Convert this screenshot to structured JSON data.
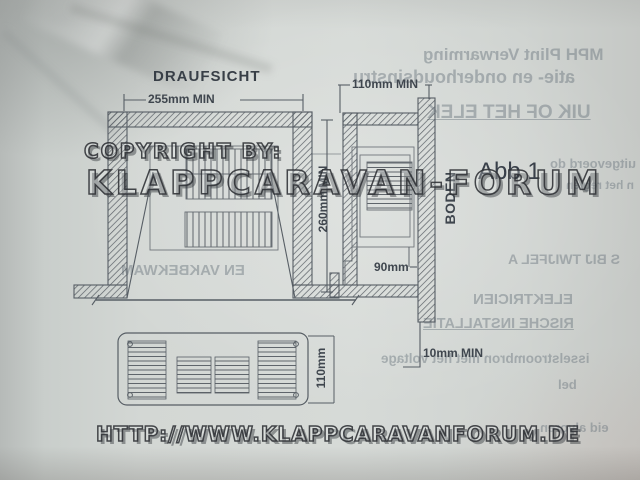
{
  "drawing": {
    "title": "DRAUFSICHT",
    "figure_label": "Abb 1",
    "floor_label": "BODEN",
    "dim_top_width": "255mm MIN",
    "dim_side_depth": "110mm MIN",
    "dim_side_height": "260mm MIN",
    "dim_duct": "90mm",
    "dim_floor_gap": "10mm MIN",
    "dim_grille_height": "110mm"
  },
  "watermark": {
    "copyright": "COPYRIGHT BY:",
    "forum": "KLAPPCARAVAN-FORUM",
    "url": "HTTP://WWW.KLAPPCARAVANFORUM.DE"
  },
  "bleedthrough": {
    "items": [
      {
        "text": "MPH Plint Verwarming"
      },
      {
        "text": "atie- en onderhoudsinstru"
      },
      {
        "text": "UIK OF HET ELEK"
      },
      {
        "text": "uitgevoerd do"
      },
      {
        "text": "n het regien"
      },
      {
        "text": "EN VAKBEKWAM"
      },
      {
        "text": "S BIJ TWIJFEL A"
      },
      {
        "text": "ELEKTRICIEN"
      },
      {
        "text": "RISCHE INSTALLATIE"
      },
      {
        "text": "isselstroombron met het voltage"
      },
      {
        "text": "bel"
      },
      {
        "text": "eid alvoren"
      }
    ]
  },
  "colors": {
    "paper": "#d2d6d3",
    "ink": "#3f464e",
    "line": "#575e65",
    "watermark_outline": "#2d3034"
  }
}
